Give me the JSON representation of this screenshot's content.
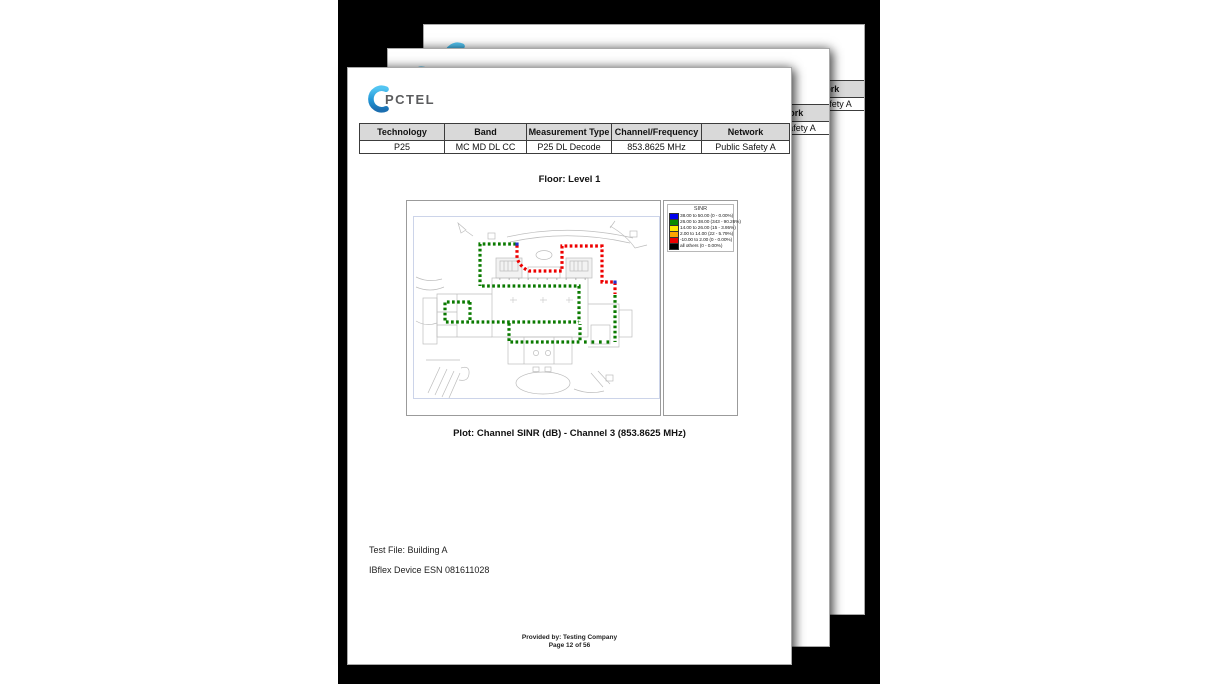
{
  "page": {
    "brand": "PCTEL",
    "header_table": {
      "columns": [
        "Technology",
        "Band",
        "Measurement Type",
        "Channel/Frequency",
        "Network"
      ],
      "values": [
        "P25",
        "MC MD DL CC",
        "P25 DL Decode",
        "853.8625 MHz",
        "Public Safety A"
      ]
    },
    "floor_heading": "Floor: Level 1",
    "plot_caption": "Plot: Channel SINR (dB) - Channel 3 (853.8625 MHz)",
    "test_file": "Test File: Building A",
    "device_line": "IBflex Device ESN 081611028",
    "footer_provided_by": "Provided by: Testing Company",
    "footer_page": "Page 12 of 56"
  },
  "legend": {
    "title": "SINR",
    "entries": [
      {
        "color": "#0000EE",
        "label": "38.00 to 50.00 (0 - 0.00%)"
      },
      {
        "color": "#0B8A00",
        "label": "26.00 to 38.00 (343 - 90.26%)"
      },
      {
        "color": "#FFEB00",
        "label": "14.00 to 26.00 (15 - 3.95%)"
      },
      {
        "color": "#FFA500",
        "label": "2.00 to 14.00 (22 - 5.79%)"
      },
      {
        "color": "#EE0000",
        "label": "-10.00 to 2.00 (0 - 0.00%)"
      },
      {
        "color": "#000000",
        "label": "all others (0 - 0.00%)"
      }
    ]
  },
  "colors": {
    "route_green": "#0A7A00",
    "route_red": "#EE0000",
    "route_marker_blue": "#2233CC",
    "table_header_bg": "#D9D9D9",
    "brand_blue_light": "#53C5F2",
    "brand_blue_dark": "#1B6EB0"
  }
}
